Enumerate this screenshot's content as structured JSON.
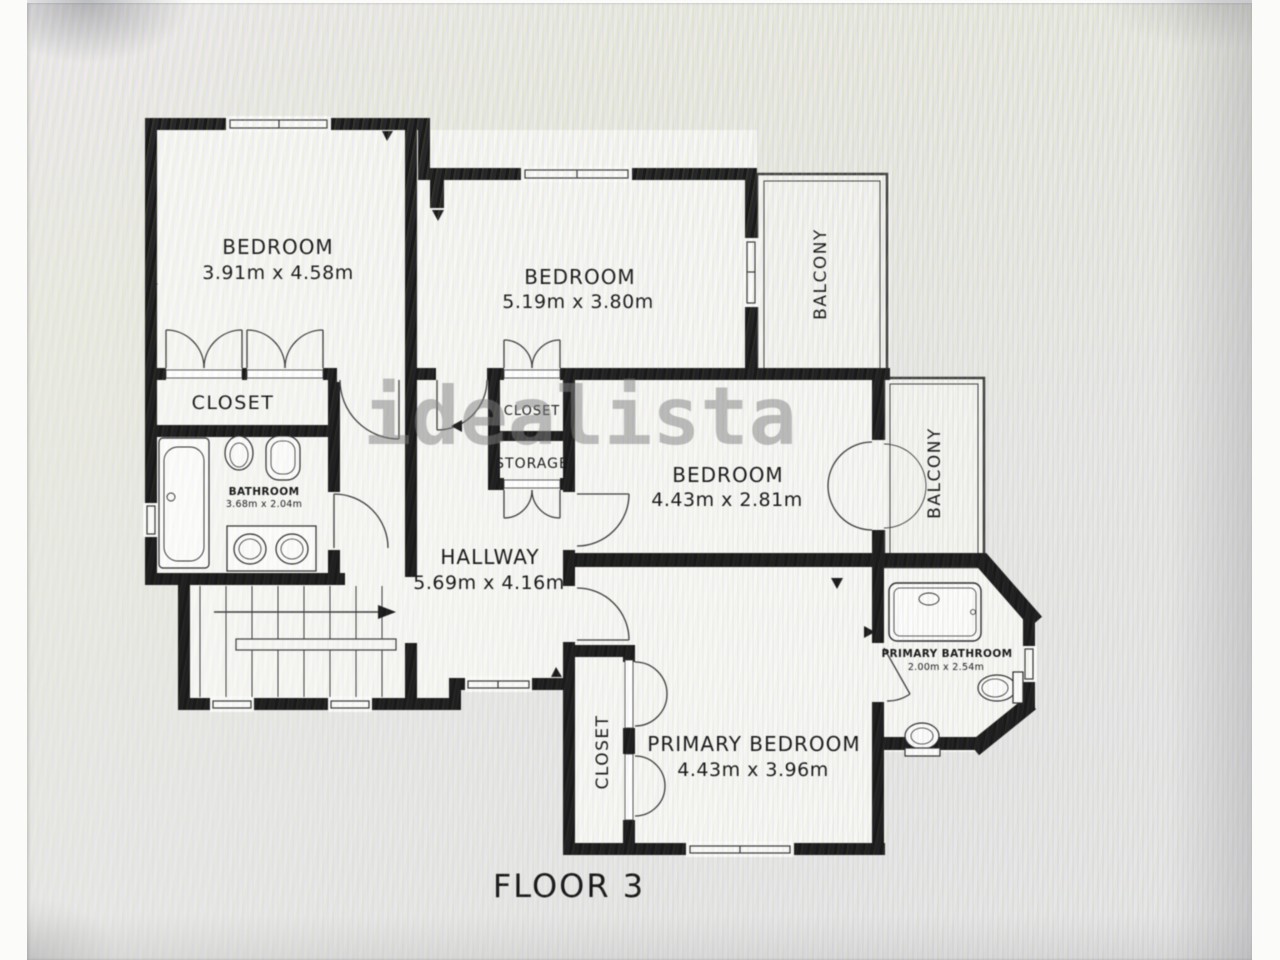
{
  "floor_plan": {
    "title": "FLOOR 3",
    "watermark": "idealista",
    "rooms": {
      "bedroom_top_left": {
        "label": "BEDROOM",
        "dimensions": "3.91m x 4.58m"
      },
      "bedroom_top_middle": {
        "label": "BEDROOM",
        "dimensions": "5.19m x 3.80m"
      },
      "bedroom_middle_right": {
        "label": "BEDROOM",
        "dimensions": "4.43m x 2.81m"
      },
      "primary_bedroom": {
        "label": "PRIMARY BEDROOM",
        "dimensions": "4.43m x 3.96m"
      },
      "hallway": {
        "label": "HALLWAY",
        "dimensions": "5.69m x 4.16m"
      },
      "bathroom": {
        "label": "BATHROOM",
        "dimensions": "3.68m x 2.04m"
      },
      "primary_bathroom": {
        "label": "PRIMARY BATHROOM",
        "dimensions": "2.00m x 2.54m"
      },
      "closet_top_left": {
        "label": "CLOSET"
      },
      "closet_middle": {
        "label": "CLOSET"
      },
      "storage": {
        "label": "STORAGE"
      },
      "closet_primary": {
        "label": "CLOSET"
      },
      "balcony_top": {
        "label": "BALCONY"
      },
      "balcony_right": {
        "label": "BALCONY"
      }
    },
    "colors": {
      "wall": "#1a1a1a",
      "floor": "#f7f7f4",
      "background": "#e8e8e9",
      "watermark": "#7d7d7d"
    }
  }
}
